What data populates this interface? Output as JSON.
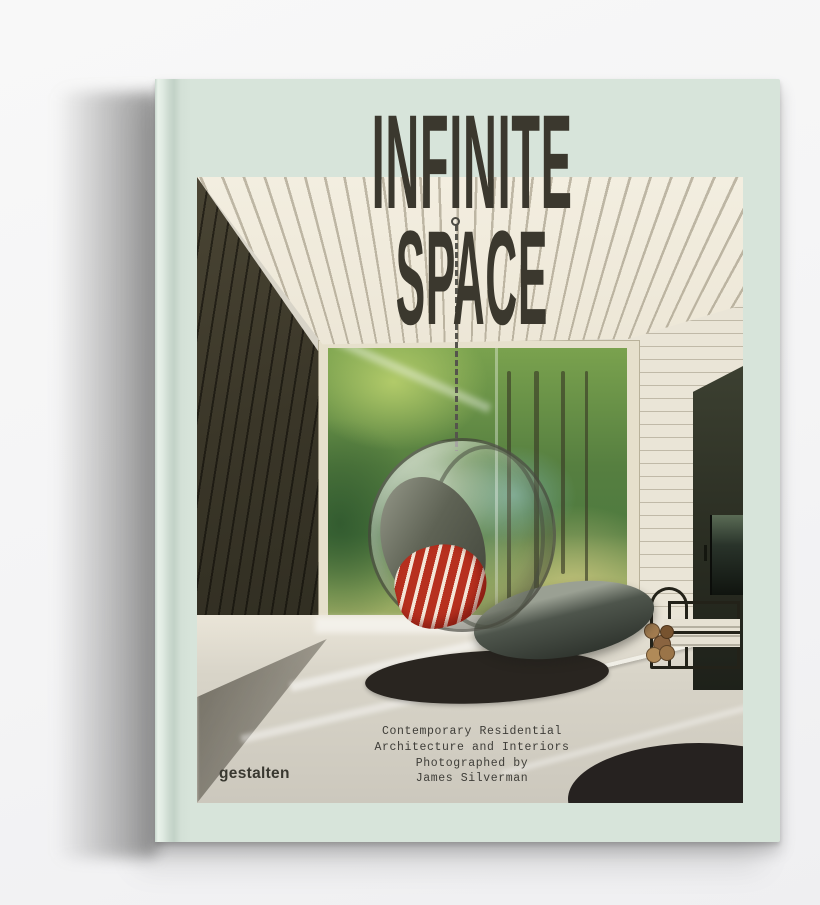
{
  "colors": {
    "background": "#f4f4f5",
    "cover": "#d7e4da",
    "title": "#3b382e",
    "subtitle": "#3e3d38",
    "publisher": "#393830",
    "wall_dark": "#3a3628",
    "forest_green": "#567f40",
    "pillow_red": "#b7301f",
    "rug": "#292520",
    "shadow": "#8c8c8c"
  },
  "book": {
    "title_line1": "INFINITE",
    "title_line2": "SPACE",
    "subtitle_lines": [
      "Contemporary Residential",
      "Architecture and Interiors",
      "Photographed by",
      "James Silverman"
    ],
    "publisher": "gestalten"
  }
}
